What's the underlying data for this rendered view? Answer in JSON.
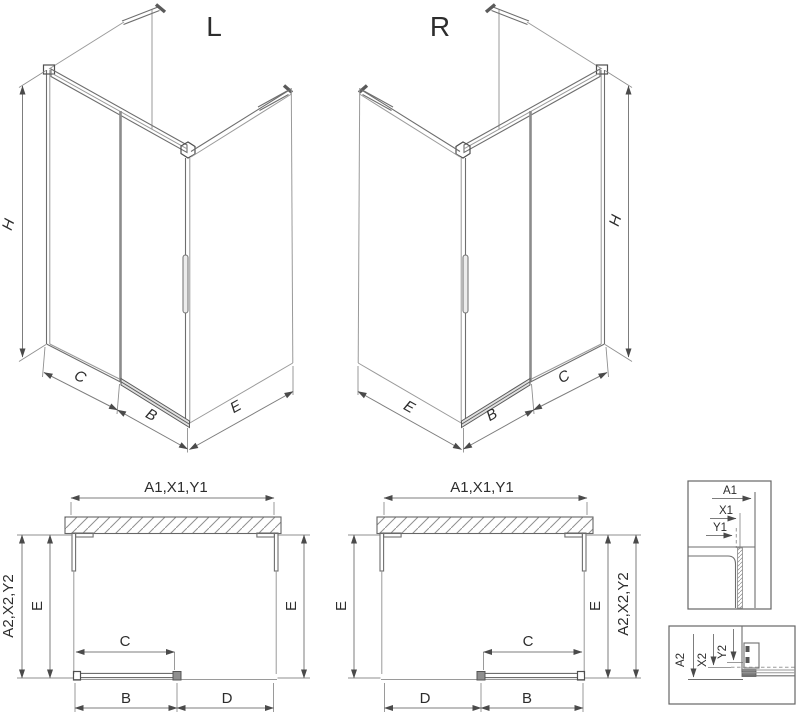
{
  "colors": {
    "background": "#ffffff",
    "line_light": "#9a9a9a",
    "line_medium": "#6e6e6e",
    "line_dark": "#4f4f4f",
    "text": "#2d2d2d"
  },
  "iso_left": {
    "title": "L",
    "dim_height": "H",
    "dim_fixed_panel": "C",
    "dim_door": "B",
    "dim_side_panel": "E"
  },
  "iso_right": {
    "title": "R",
    "dim_height": "H",
    "dim_side_panel": "E",
    "dim_door": "B",
    "dim_fixed_panel": "C"
  },
  "plan_left": {
    "dim_width_top": "A1,X1,Y1",
    "dim_depth_outer": "A2,X2,Y2",
    "dim_depth_inner": "E",
    "dim_depth_right": "E",
    "dim_door_travel": "C",
    "dim_door": "B",
    "dim_opening": "D"
  },
  "plan_right": {
    "dim_width_top": "A1,X1,Y1",
    "dim_depth_left": "E",
    "dim_depth_inner": "E",
    "dim_depth_outer": "A2,X2,Y2",
    "dim_door_travel": "C",
    "dim_opening": "D",
    "dim_door": "B"
  },
  "detail_wall_profile": {
    "dim_a": "A1",
    "dim_x": "X1",
    "dim_y": "Y1"
  },
  "detail_bottom_rail": {
    "dim_a": "A2",
    "dim_x": "X2",
    "dim_y": "Y2"
  }
}
